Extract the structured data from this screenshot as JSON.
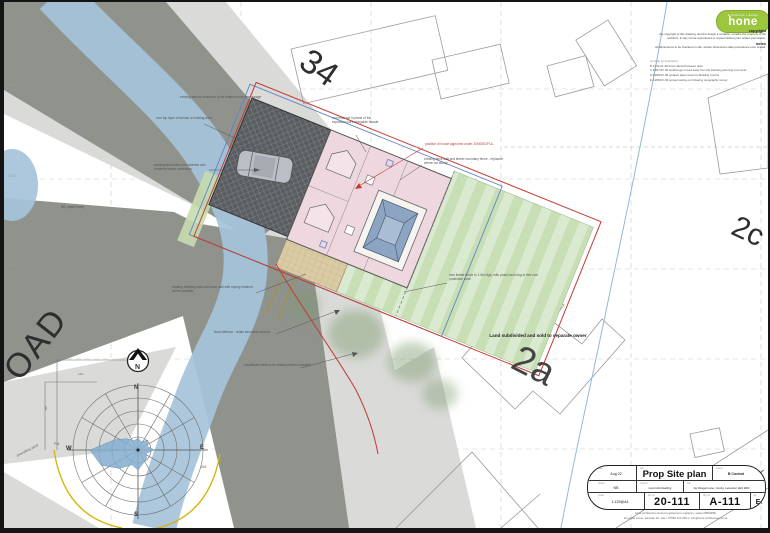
{
  "colors": {
    "road": "#8f938c",
    "verge": "#dadad8",
    "river": "#a6c3da",
    "house_pink": "#eed7de",
    "lawn_green": "#cfe2bf",
    "patio_tan": "#d9c9a2",
    "drive_hatch": "#5a5e61",
    "boundary_red": "#c43b33",
    "approved_blue": "#5f83c8",
    "sun_yellow": "#d7b300",
    "logo_green": "#9cc63e",
    "lantern_blue": "#8ba5c3"
  },
  "logo": {
    "brand": "hone",
    "tagline": "architecture + design"
  },
  "info": {
    "copyright_heading": "copyright",
    "copyright_body": "the copyright of this drawing, and the design it contains, remains the property of the architect. It may not be reproduced or copied without prior written permission.",
    "notes_heading": "notes",
    "notes_body": "All dimensions to be checked on site, written dimensions take precedence over scaled."
  },
  "revisions": {
    "header": "rev    date    by    description",
    "items": [
      "B   17/11/22   JM   fence altered between plots",
      "C   28/07/23   JM   bed/lounge moved away from FE following planning comments",
      "D   04/08/23   JM   updated plans issued to Building Control",
      "E   24/08/23   JM   revised setting out following topographic survey"
    ]
  },
  "plots": {
    "p34": "34",
    "p2a": "2a",
    "p2c": "2c",
    "road": "OAD",
    "land_note": "Land subdivided and sold to separate owner"
  },
  "grid_labels": [
    "580",
    "570",
    "560"
  ],
  "annotations": [
    "existing tarmac crossover to be retained over new garage",
    "new top layer of tarmac to existing drive",
    "existing brick wall to be retained and rendered where necessary",
    "existing retaining wall and stone wall with coping retained where possible",
    "flood defence - retain structures around",
    "established trees to be retained where possible",
    "new timber fence to 1.8m high, with posts hand dug in tree root protection zone",
    "existing brick wall and timber boundary fence - replaced where not sturdy",
    "roof pitch set in plane of the expansion joint alongside facade",
    "WL (water level)"
  ],
  "red_annotation": "position of house approved under 20/00567/FUL",
  "compass": {
    "north_symbol": "N",
    "n": "N",
    "e": "E",
    "s": "S",
    "w": "W",
    "am": "AM",
    "pm": "PM",
    "prevailing": "prevailing wind",
    "dim_width": "14m",
    "dim_height": "8m"
  },
  "title_block": {
    "labels": {
      "date": "date",
      "title": "title",
      "status": "status",
      "drawn": "drawn",
      "project": "project",
      "site": "site",
      "scale": "scale",
      "job": "job no",
      "drg": "drg no",
      "rev": "rev"
    },
    "date": "Aug 22",
    "title": "Prop Site plan",
    "status": "B Control",
    "drawn": "NB",
    "project": "new build dwelling",
    "site": "2a Chapel Lane, Cosby, Leicester LE9 1RD",
    "scale": "1:125@A4",
    "job_no": "20-111",
    "drg_no": "A-111",
    "rev": "E"
  },
  "footer": {
    "line1": "hone architecture limited    registered in england + wales    08690856",
    "line2": "10 poplar street, leicester le1 1aa    t: 07584 123 456    e: info@hone-architecture.co.uk"
  }
}
